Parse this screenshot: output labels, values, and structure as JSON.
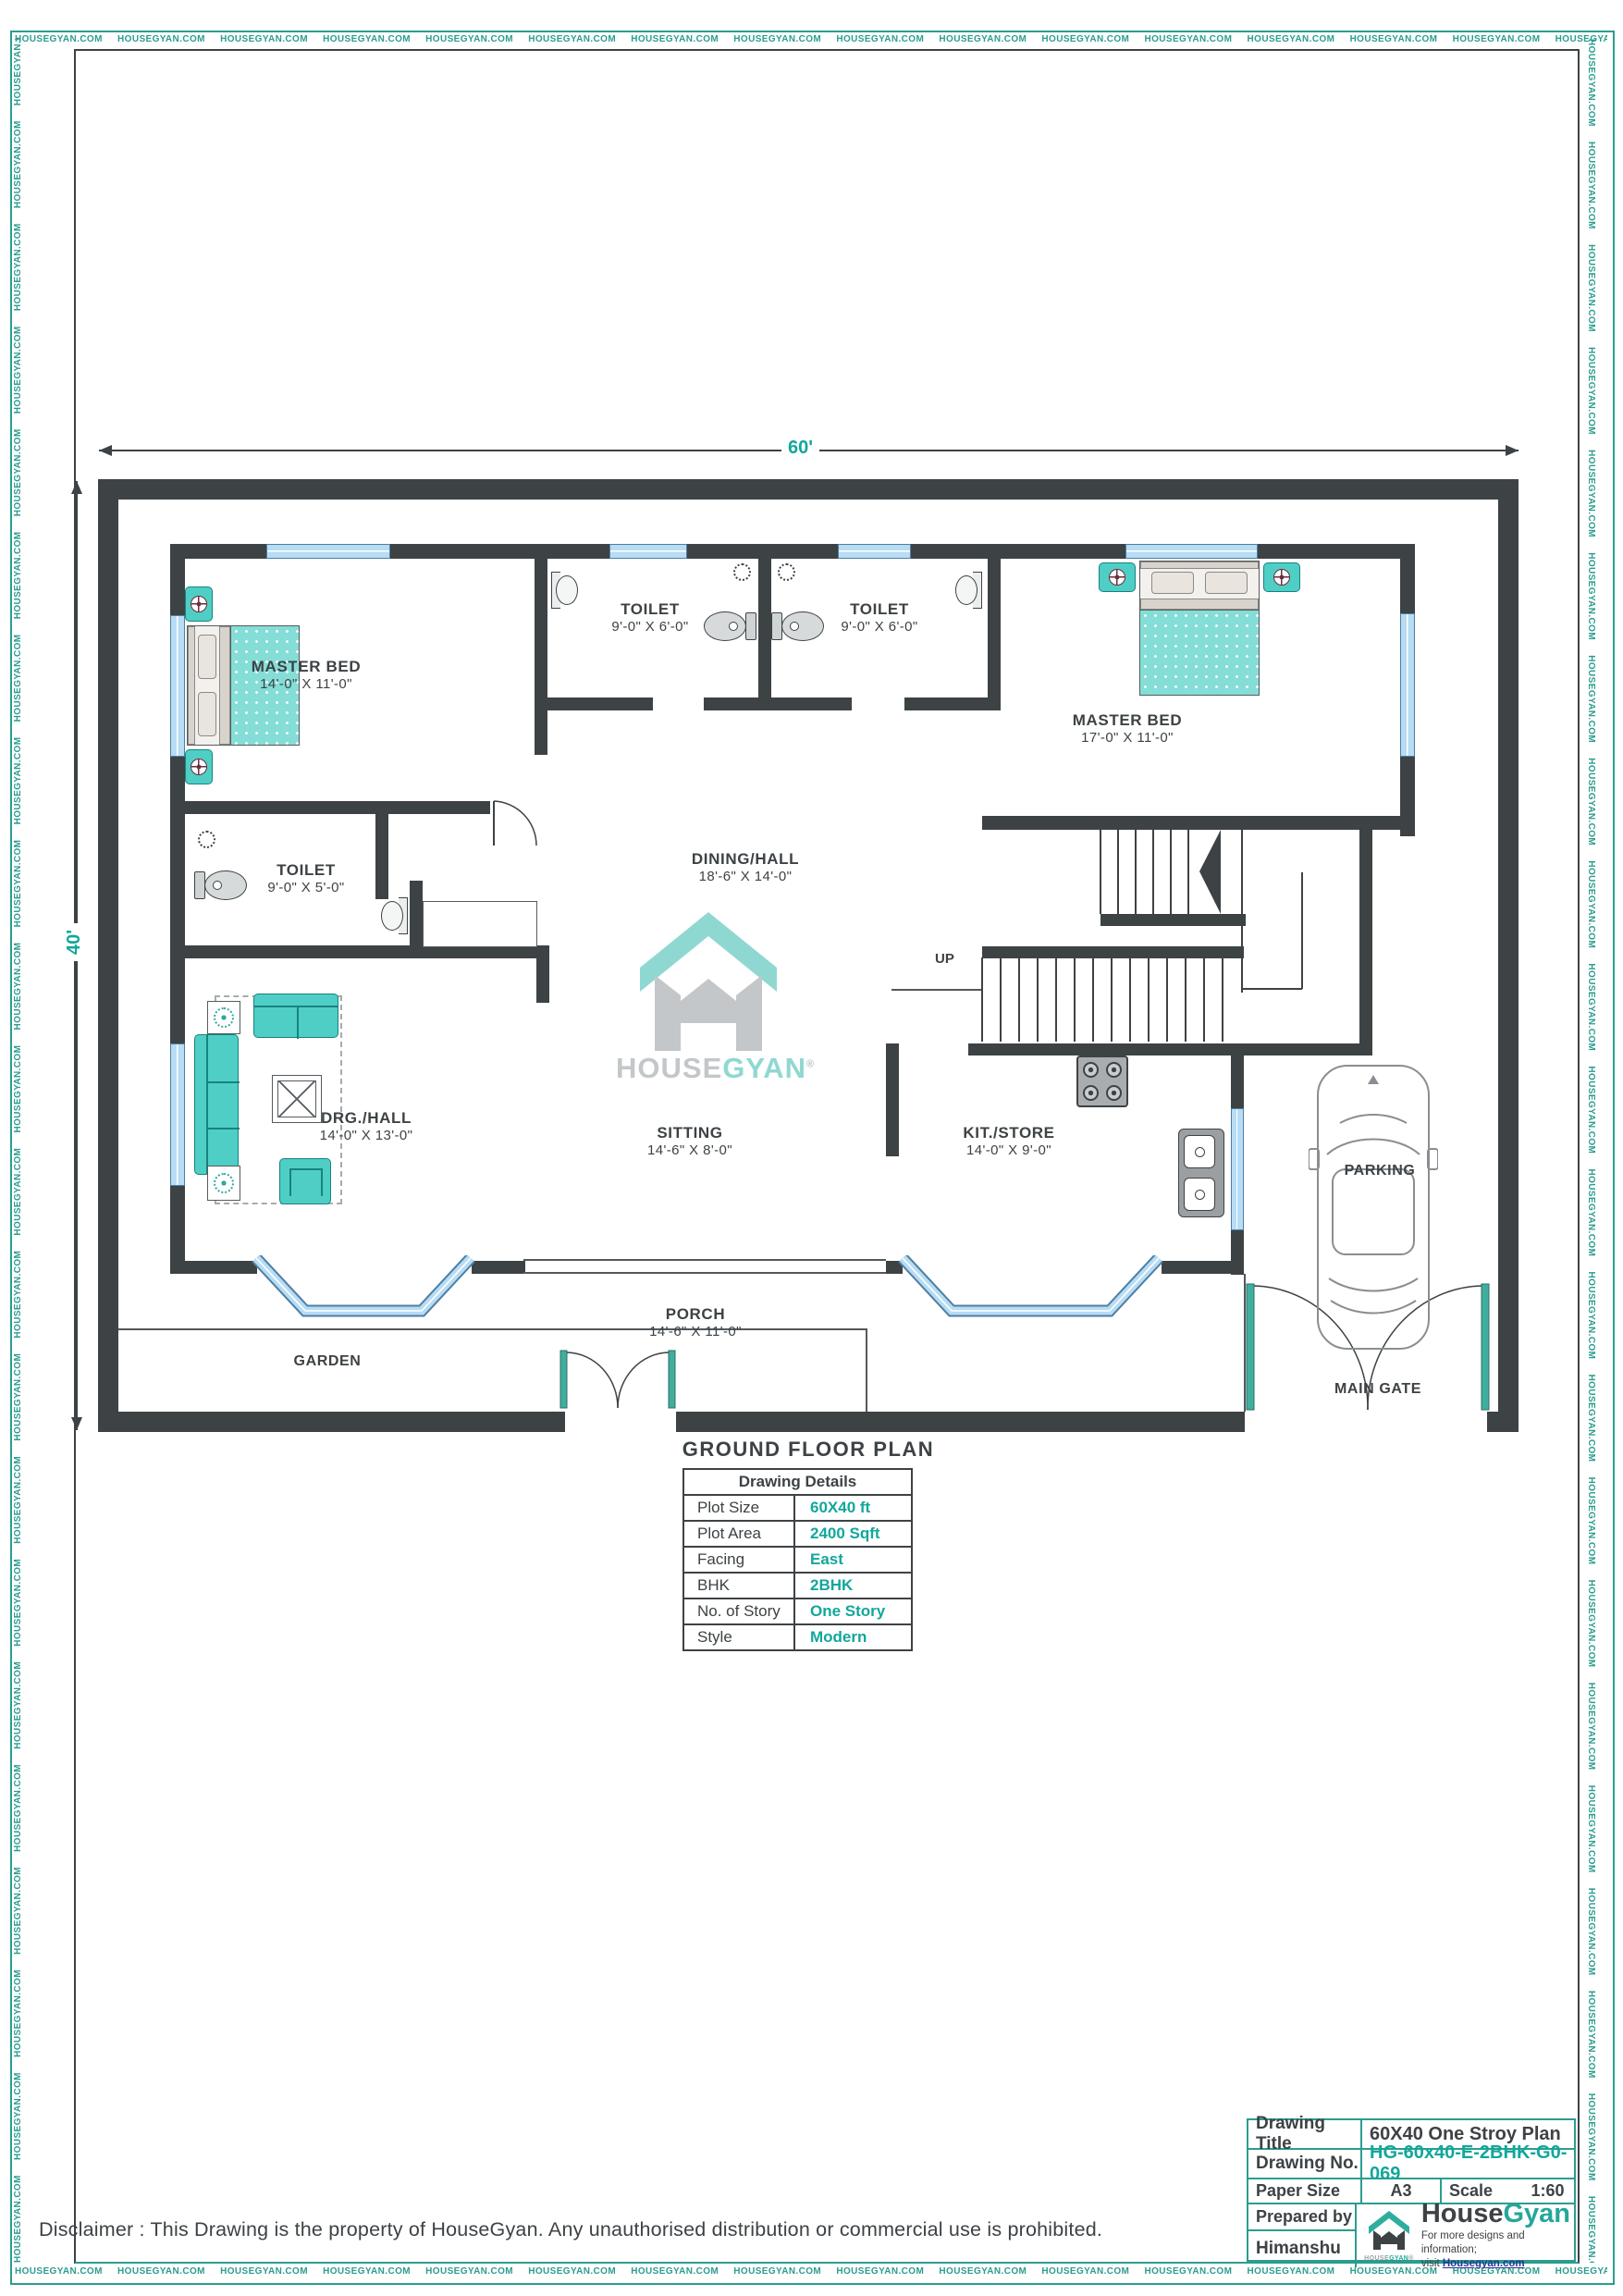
{
  "colors": {
    "brand_teal": "#2b9d8f",
    "wall": "#3d4245",
    "value_teal": "#12a79b",
    "window_blue": "#b7dcf4",
    "furniture_teal": "#4fcec6"
  },
  "watermark": {
    "text": "HOUSEGYAN.COM"
  },
  "dim_top": "60'",
  "dim_left": "40'",
  "plan": {
    "title": "GROUND FLOOR PLAN",
    "up_label": "UP",
    "rooms": [
      {
        "name": "MASTER BED",
        "dims": "14'-0\" X 11'-0\""
      },
      {
        "name": "TOILET",
        "dims": "9'-0\" X 6'-0\""
      },
      {
        "name": "TOILET",
        "dims": "9'-0\" X 6'-0\""
      },
      {
        "name": "MASTER BED",
        "dims": "17'-0\" X 11'-0\""
      },
      {
        "name": "TOILET",
        "dims": "9'-0\" X 5'-0\""
      },
      {
        "name": "DINING/HALL",
        "dims": "18'-6\" X 14'-0\""
      },
      {
        "name": "DRG./HALL",
        "dims": "14'-0\" X 13'-0\""
      },
      {
        "name": "SITTING",
        "dims": "14'-6\" X 8'-0\""
      },
      {
        "name": "KIT./STORE",
        "dims": "14'-0\" X 9'-0\""
      },
      {
        "name": "PORCH",
        "dims": "14'-6\" X 11'-0\""
      },
      {
        "name": "GARDEN",
        "dims": ""
      },
      {
        "name": "PARKING",
        "dims": ""
      },
      {
        "name": "MAIN GATE",
        "dims": ""
      }
    ]
  },
  "center_logo": {
    "part1": "HOUSE",
    "part2": "GYAN",
    "reg": "®"
  },
  "details_table": {
    "title": "Drawing Details",
    "rows": [
      {
        "label": "Plot Size",
        "value": "60X40 ft"
      },
      {
        "label": "Plot Area",
        "value": "2400 Sqft"
      },
      {
        "label": "Facing",
        "value": "East"
      },
      {
        "label": "BHK",
        "value": "2BHK"
      },
      {
        "label": "No. of Story",
        "value": "One Story"
      },
      {
        "label": "Style",
        "value": "Modern"
      }
    ]
  },
  "title_block": {
    "drawing_title_label": "Drawing Title",
    "drawing_title_value": "60X40 One Stroy Plan",
    "drawing_no_label": "Drawing No.",
    "drawing_no_value": "HG-60x40-E-2BHK-G0-069",
    "paper_size_label": "Paper Size",
    "paper_size_value": "A3",
    "scale_label": "Scale",
    "scale_value": "1:60",
    "prepared_by_label": "Prepared by",
    "prepared_by_value": "Himanshu",
    "logo": {
      "word1": "House",
      "word2": "Gyan",
      "tagline1": "For more designs and information;",
      "tagline2_prefix": "visit ",
      "tagline2_link": "Housegyan.com",
      "icon_label1": "HOUSE",
      "icon_label2": "GYAN",
      "reg": "®"
    }
  },
  "disclaimer": "Disclaimer : This Drawing is the property of HouseGyan. Any unauthorised distribution or commercial use is prohibited."
}
